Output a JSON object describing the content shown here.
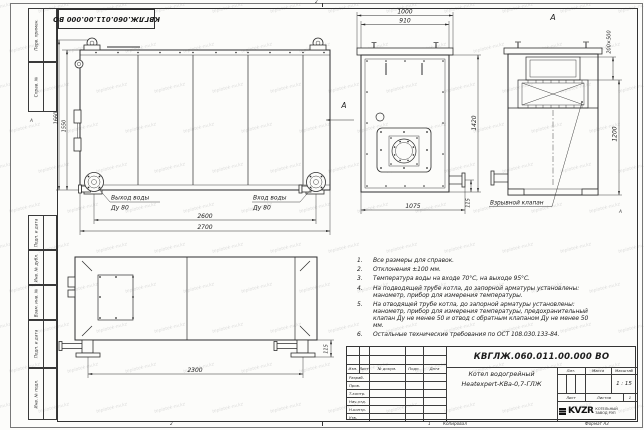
{
  "sheet": {
    "watermark": "teplotek-nv.kz",
    "stamp_top": "КВГЛЖ.060.011.00.000 ВО",
    "zones": {
      "top": "2",
      "bottom_left": "2",
      "bottom_right": "1",
      "left": "А",
      "right": "А"
    },
    "margin_labels": [
      "Перв. примен.",
      "Справ. №",
      "Подп. и дата",
      "Инв. № дубл.",
      "Взам. инв. №",
      "Подп. и дата",
      "Инв. № подл."
    ],
    "footer": {
      "copied": "Копировал",
      "format": "Формат А3"
    }
  },
  "views": {
    "side": {
      "dim_height_outer": "1660",
      "dim_height_inner": "1550",
      "dim_width_inner": "2600",
      "dim_width_outer": "2700",
      "outlet_line1": "Выход воды",
      "outlet_line2": "Ду 80",
      "inlet_line1": "Вход воды",
      "inlet_line2": "Ду 80",
      "view_arrow_label": "А"
    },
    "front": {
      "dim_width_outer": "1000",
      "dim_width_inner": "910",
      "dim_height": "1420",
      "dim_bottom": "1075",
      "dim_leg": "115"
    },
    "rear": {
      "view_title": "А",
      "dim_hatch": "200×500",
      "dim_height": "1200",
      "valve_label": "Взрывной клапан"
    },
    "plan": {
      "dim_length": "2300",
      "dim_leg": "115"
    }
  },
  "notes": {
    "items": [
      {
        "num": "1.",
        "text": "Все размеры для справок."
      },
      {
        "num": "2.",
        "text": "Отклонения ±100 мм."
      },
      {
        "num": "3.",
        "text": "Температура воды на входе 70°С, на выходе 95°С."
      },
      {
        "num": "4.",
        "text": "На подводящей трубе котла, до запорной арматуры установлены: манометр, прибор для измерения температуры."
      },
      {
        "num": "5.",
        "text": "На отводящей трубе котла, до запорной арматуры установлены: манометр, прибор для измерения температуры, предохранительный клапан Ду не менее 50 и отвод с обратным клапаном Ду не менее 50 мм."
      },
      {
        "num": "6.",
        "text": "Остальные технические требования по ОСТ 108.030.133-84."
      }
    ]
  },
  "title_block": {
    "doc_number": "КВГЛЖ.060.011.00.000 ВО",
    "rev_cols": [
      "Изм.",
      "Лист",
      "№ докум.",
      "Подп.",
      "Дата"
    ],
    "sign_rows": [
      "Разраб.",
      "Пров.",
      "Т.контр.",
      "Нач.отд.",
      "Н.контр.",
      "Утв."
    ],
    "name_line1": "Котел водогрейный",
    "name_line2": "Heatexpert-КВа-0,7-ГЛЖ",
    "lit_label": "Лит.",
    "mass_label": "Масса",
    "scale_label": "Масштаб",
    "scale_value": "1 : 15",
    "sheet_label": "Лист",
    "sheets_label": "Листов",
    "sheets_value": "1",
    "logo_text": "KVZR",
    "company_line1": "КОТЕЛЬНЫЙ",
    "company_line2": "ЗАВОД РЭП"
  }
}
